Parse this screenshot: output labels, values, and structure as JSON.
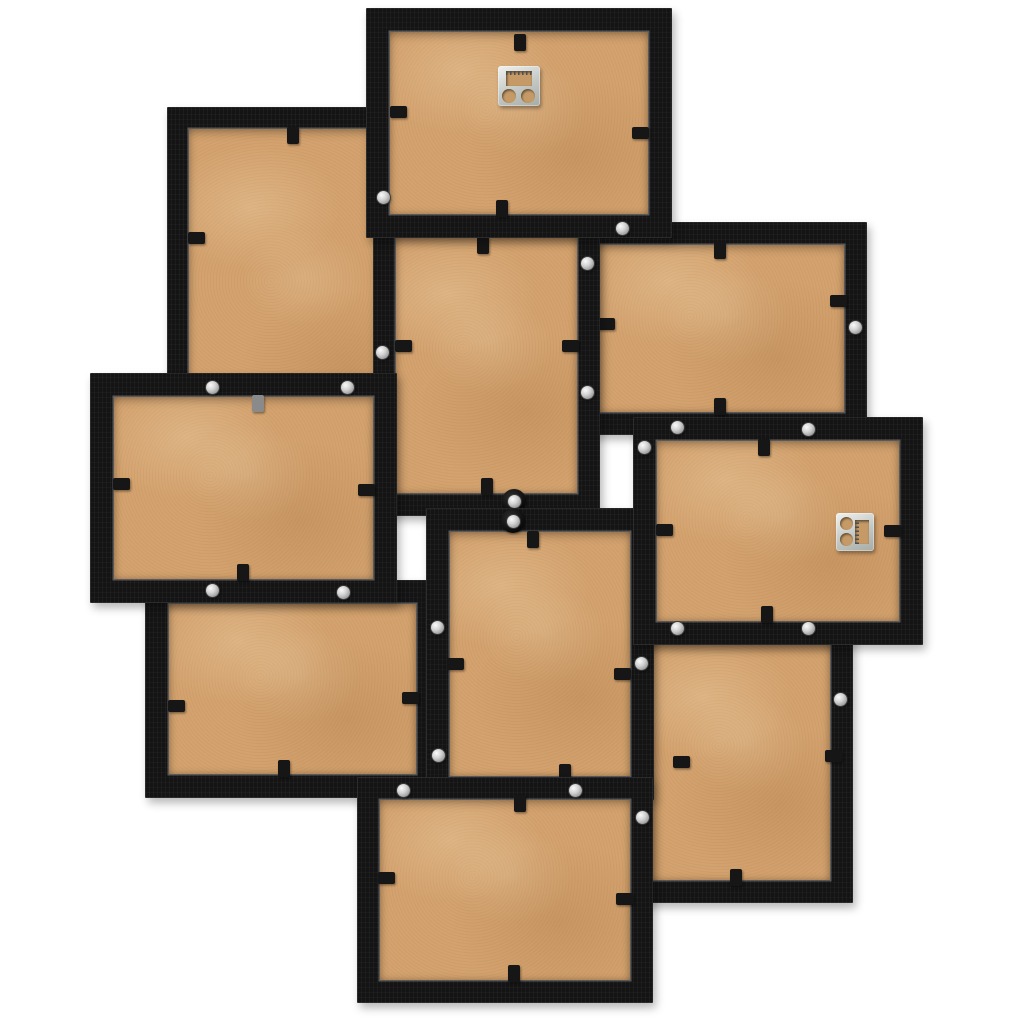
{
  "meta": {
    "subject": "Back view of a black collage photo frame wall decoration with ten overlapping frames",
    "background_color": "#ffffff",
    "frame_count": 10
  },
  "palette": {
    "frame_black": "#141414",
    "frame_highlight": "#2e2e2e",
    "mdf_tan": "#d3a26e",
    "mdf_tan_dark": "#c59a66",
    "screw_silver": "#d2d2d2",
    "hanger_silver": "#c3c7c3",
    "tab_black": "#161616",
    "tab_gray": "#8a8a8a"
  },
  "scene": {
    "width": 1024,
    "height": 1024
  },
  "frames": [
    {
      "id": "upper-left-portrait",
      "orientation": "portrait",
      "x": 167,
      "y": 107,
      "w": 265,
      "h": 398,
      "border": 22,
      "z": 1,
      "tabs": [
        {
          "x": 293,
          "y": 135,
          "dir": "v"
        },
        {
          "x": 196,
          "y": 238,
          "dir": "h"
        }
      ],
      "screws": [],
      "hanger": null
    },
    {
      "id": "upper-right-landscape",
      "orientation": "landscape",
      "x": 577,
      "y": 222,
      "w": 290,
      "h": 213,
      "border": 23,
      "z": 2,
      "tabs": [
        {
          "x": 720,
          "y": 250,
          "dir": "v"
        },
        {
          "x": 606,
          "y": 324,
          "dir": "h"
        },
        {
          "x": 838,
          "y": 301,
          "dir": "h"
        },
        {
          "x": 720,
          "y": 406,
          "dir": "v"
        }
      ],
      "screws": [
        {
          "x": 855,
          "y": 327
        }
      ],
      "hanger": null
    },
    {
      "id": "lower-left-landscape",
      "orientation": "landscape",
      "x": 145,
      "y": 580,
      "w": 295,
      "h": 218,
      "border": 24,
      "z": 3,
      "tabs": [
        {
          "x": 176,
          "y": 706,
          "dir": "h"
        },
        {
          "x": 410,
          "y": 698,
          "dir": "h"
        },
        {
          "x": 284,
          "y": 768,
          "dir": "v"
        }
      ],
      "screws": [],
      "hanger": null
    },
    {
      "id": "center-upper-portrait",
      "orientation": "portrait",
      "x": 373,
      "y": 215,
      "w": 227,
      "h": 301,
      "border": 23,
      "z": 4,
      "tabs": [
        {
          "x": 483,
          "y": 245,
          "dir": "v"
        },
        {
          "x": 403,
          "y": 346,
          "dir": "h"
        },
        {
          "x": 570,
          "y": 346,
          "dir": "h"
        },
        {
          "x": 487,
          "y": 486,
          "dir": "v"
        }
      ],
      "screws": [
        {
          "x": 587,
          "y": 263
        },
        {
          "x": 587,
          "y": 392
        },
        {
          "x": 382,
          "y": 352
        },
        {
          "x": 514,
          "y": 501,
          "washer": true
        }
      ],
      "hanger": null
    },
    {
      "id": "lower-right-portrait",
      "orientation": "portrait",
      "x": 630,
      "y": 622,
      "w": 223,
      "h": 281,
      "border": 23,
      "z": 5,
      "tabs": [
        {
          "x": 681,
          "y": 762,
          "dir": "h"
        },
        {
          "x": 833,
          "y": 756,
          "dir": "h"
        },
        {
          "x": 736,
          "y": 877,
          "dir": "v"
        }
      ],
      "screws": [
        {
          "x": 840,
          "y": 699
        }
      ],
      "hanger": null
    },
    {
      "id": "center-lower-portrait",
      "orientation": "portrait",
      "x": 426,
      "y": 508,
      "w": 228,
      "h": 292,
      "border": 24,
      "z": 6,
      "tabs": [
        {
          "x": 533,
          "y": 539,
          "dir": "v"
        },
        {
          "x": 455,
          "y": 664,
          "dir": "h"
        },
        {
          "x": 622,
          "y": 674,
          "dir": "h"
        },
        {
          "x": 565,
          "y": 772,
          "dir": "v"
        }
      ],
      "screws": [
        {
          "x": 513,
          "y": 521,
          "washer": true
        },
        {
          "x": 437,
          "y": 627
        },
        {
          "x": 438,
          "y": 755
        },
        {
          "x": 641,
          "y": 663
        }
      ],
      "hanger": null
    },
    {
      "id": "bottom-center-landscape",
      "orientation": "landscape",
      "x": 357,
      "y": 777,
      "w": 296,
      "h": 226,
      "border": 23,
      "z": 7,
      "tabs": [
        {
          "x": 520,
          "y": 803,
          "dir": "v"
        },
        {
          "x": 386,
          "y": 878,
          "dir": "h"
        },
        {
          "x": 624,
          "y": 899,
          "dir": "h"
        },
        {
          "x": 514,
          "y": 973,
          "dir": "v"
        }
      ],
      "screws": [
        {
          "x": 403,
          "y": 790
        },
        {
          "x": 575,
          "y": 790
        },
        {
          "x": 642,
          "y": 817
        }
      ],
      "hanger": null
    },
    {
      "id": "middle-left-landscape",
      "orientation": "landscape",
      "x": 90,
      "y": 373,
      "w": 307,
      "h": 230,
      "border": 24,
      "z": 8,
      "tabs": [
        {
          "x": 258,
          "y": 403,
          "dir": "v",
          "color": "#8a8a8a"
        },
        {
          "x": 121,
          "y": 484,
          "dir": "h"
        },
        {
          "x": 366,
          "y": 490,
          "dir": "h"
        },
        {
          "x": 243,
          "y": 572,
          "dir": "v"
        }
      ],
      "screws": [
        {
          "x": 212,
          "y": 387
        },
        {
          "x": 347,
          "y": 387
        },
        {
          "x": 212,
          "y": 590
        },
        {
          "x": 343,
          "y": 592
        }
      ],
      "hanger": null
    },
    {
      "id": "top-center-landscape",
      "orientation": "landscape",
      "x": 366,
      "y": 8,
      "w": 306,
      "h": 230,
      "border": 24,
      "z": 9,
      "tabs": [
        {
          "x": 520,
          "y": 42,
          "dir": "v"
        },
        {
          "x": 398,
          "y": 112,
          "dir": "h"
        },
        {
          "x": 640,
          "y": 133,
          "dir": "h"
        },
        {
          "x": 502,
          "y": 208,
          "dir": "v"
        }
      ],
      "screws": [
        {
          "x": 383,
          "y": 197
        },
        {
          "x": 622,
          "y": 228
        }
      ],
      "hanger": {
        "x": 498,
        "y": 66,
        "w": 42,
        "h": 40,
        "slot": {
          "x": 8,
          "y": 5,
          "w": 26,
          "h": 15
        },
        "teeth": {
          "x": 8,
          "y": 5,
          "w": 26,
          "h": 4,
          "dir": "h"
        },
        "holes": [
          {
            "x": 4,
            "y": 23,
            "d": 14
          },
          {
            "x": 23,
            "y": 23,
            "d": 14
          }
        ]
      }
    },
    {
      "id": "middle-right-landscape",
      "orientation": "landscape",
      "x": 633,
      "y": 417,
      "w": 290,
      "h": 228,
      "border": 24,
      "z": 10,
      "tabs": [
        {
          "x": 764,
          "y": 447,
          "dir": "v"
        },
        {
          "x": 664,
          "y": 530,
          "dir": "h"
        },
        {
          "x": 892,
          "y": 531,
          "dir": "h"
        },
        {
          "x": 767,
          "y": 614,
          "dir": "v"
        }
      ],
      "screws": [
        {
          "x": 677,
          "y": 427
        },
        {
          "x": 808,
          "y": 429
        },
        {
          "x": 644,
          "y": 447
        },
        {
          "x": 677,
          "y": 628
        },
        {
          "x": 808,
          "y": 628
        }
      ],
      "hanger": {
        "x": 836,
        "y": 513,
        "w": 38,
        "h": 38,
        "slot": {
          "x": 19,
          "y": 7,
          "w": 14,
          "h": 24
        },
        "teeth": {
          "x": 19,
          "y": 7,
          "w": 4,
          "h": 24,
          "dir": "v"
        },
        "holes": [
          {
            "x": 4,
            "y": 4,
            "d": 13
          },
          {
            "x": 4,
            "y": 20,
            "d": 13
          }
        ]
      }
    }
  ]
}
